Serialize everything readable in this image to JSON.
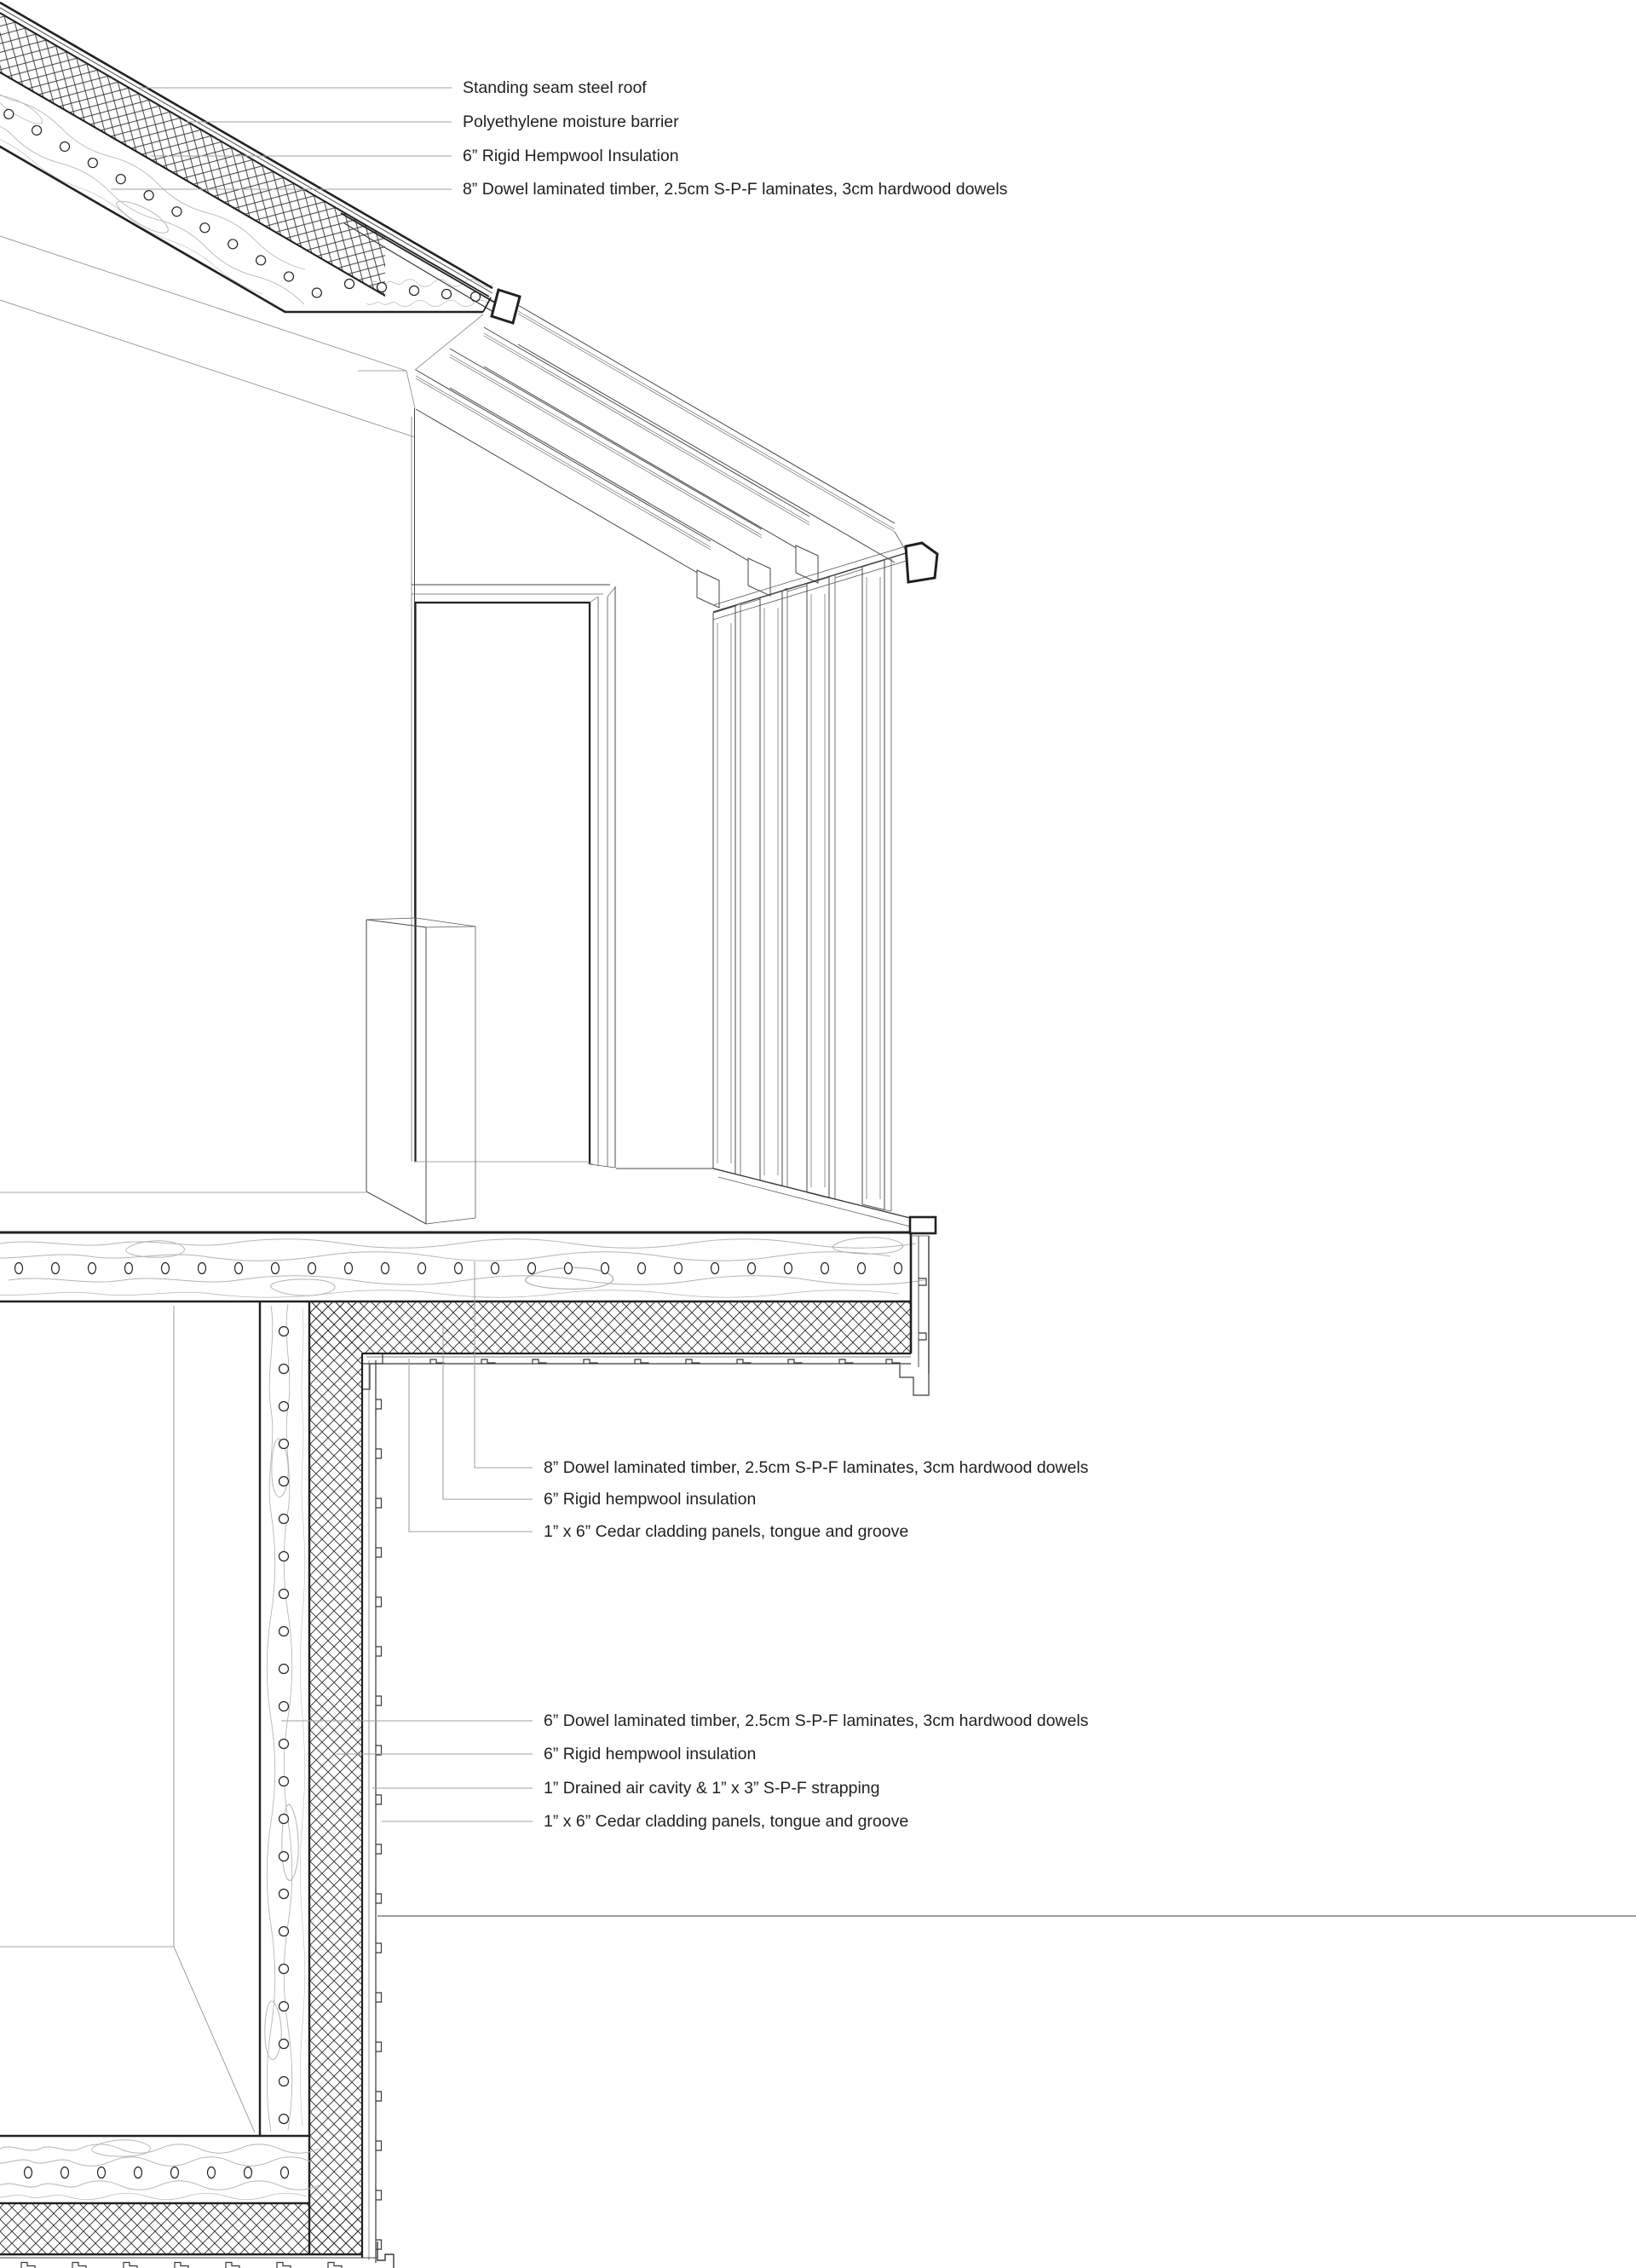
{
  "drawing": {
    "type": "architectural axonometric wall-roof-floor section detail",
    "colors": {
      "background": "#ffffff",
      "section_line": "#232022",
      "light_line": "#8b8d90",
      "leader_line": "#9da0a2",
      "wood_grain": "#b2b4b7",
      "text": "#221f20"
    },
    "callouts": {
      "roof": [
        {
          "text": "Standing seam steel roof"
        },
        {
          "text": "Polyethylene moisture barrier"
        },
        {
          "text": "6” Rigid Hempwool Insulation"
        },
        {
          "text": "8” Dowel laminated timber, 2.5cm S-P-F laminates, 3cm hardwood dowels"
        }
      ],
      "floor_edge": [
        {
          "text": "8” Dowel laminated timber, 2.5cm S-P-F laminates, 3cm hardwood dowels"
        },
        {
          "text": "6” Rigid hempwool insulation"
        },
        {
          "text": "1” x 6” Cedar cladding panels, tongue and groove"
        }
      ],
      "wall": [
        {
          "text": "6” Dowel laminated timber, 2.5cm S-P-F laminates, 3cm hardwood dowels"
        },
        {
          "text": "6” Rigid hempwool insulation"
        },
        {
          "text": "1” Drained air cavity & 1” x 3” S-P-F strapping"
        },
        {
          "text": "1” x 6” Cedar cladding panels, tongue and groove"
        }
      ]
    }
  }
}
